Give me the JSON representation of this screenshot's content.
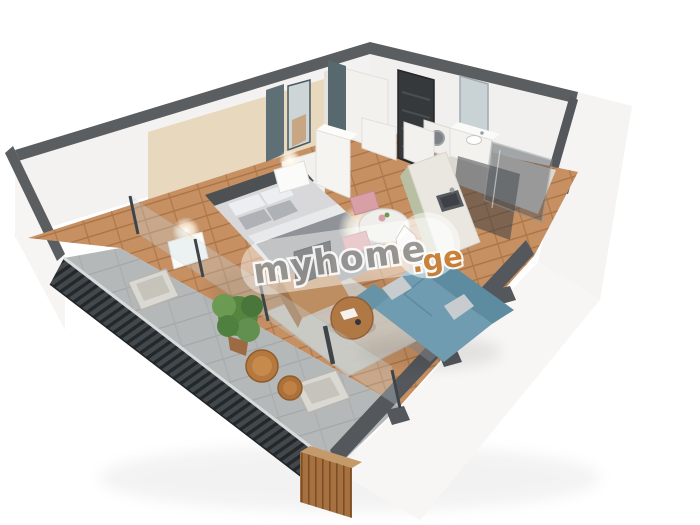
{
  "watermark": {
    "brand": "myhome",
    "tld": ".ge"
  },
  "palette": {
    "brand_text": "#8e8d8a",
    "brand_tld": "#c87b2f",
    "wall_top": "#5a5e61",
    "wall_white": "#f3f2f0",
    "accent_wall": "#e8d8bd",
    "wood_floor": "#c69063",
    "balcony_floor": "#b5b8b9",
    "railing_dark": "#43484c",
    "sofa": "#6f9cb0",
    "sofa_back": "#5d8ca0",
    "kitchen_cabinet": "#b9bfa2",
    "dining_chair": "#d8a0a6",
    "coffee_table": "#b07845",
    "door": "#36393c",
    "plant": "#56853f",
    "bed_blanket": "#8f9296",
    "partition_slate": "#5e6f76"
  }
}
